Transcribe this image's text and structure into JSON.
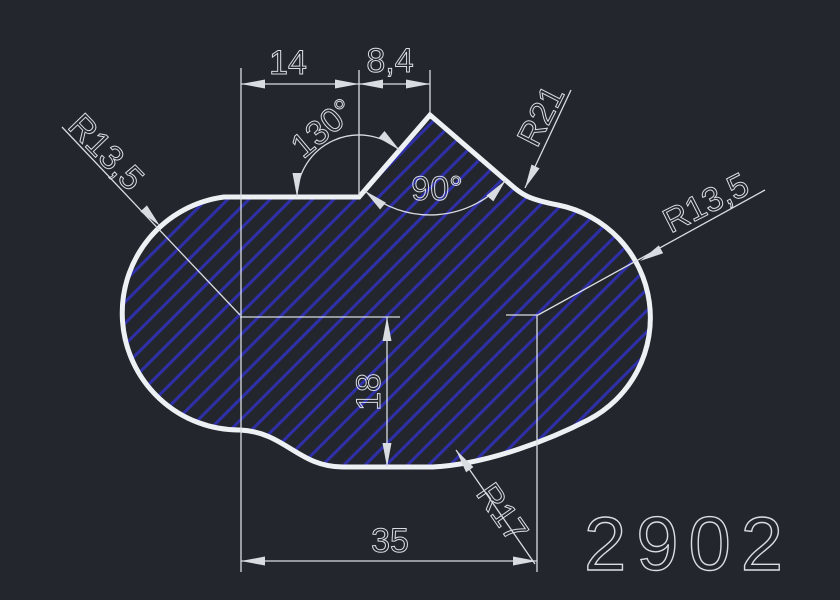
{
  "canvas": {
    "background": "#23272d"
  },
  "colors": {
    "outline": "#eef1f4",
    "hatch": "#2f2fa8",
    "dimension": "#d9dde2"
  },
  "part": {
    "number": "2902"
  },
  "dimensions": {
    "top_left_width": "14",
    "top_right_width": "8,4",
    "flank_angle": "130°",
    "notch_angle": "90°",
    "notch_radius": "R21",
    "left_lobe_radius": "R13,5",
    "right_lobe_radius": "R13,5",
    "center_height": "18",
    "bottom_fillet_radius": "R17",
    "overall_width": "35"
  }
}
